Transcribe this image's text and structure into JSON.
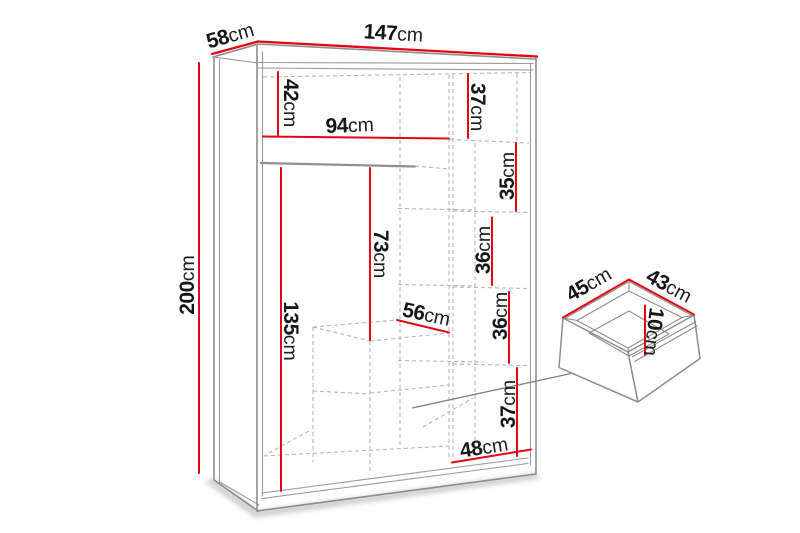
{
  "diagram": {
    "title": "wardrobe-dimension-diagram",
    "unit": "cm",
    "colors": {
      "dimension_line": "#e30613",
      "outline": "#8d8d8d",
      "dashed": "#b7b7b7",
      "label": "#161616"
    },
    "wardrobe": {
      "total_width": {
        "num": "147",
        "unit": "cm"
      },
      "total_depth": {
        "num": "58",
        "unit": "cm"
      },
      "total_height": {
        "num": "200",
        "unit": "cm"
      },
      "top_left_compartment_height": {
        "num": "42",
        "unit": "cm"
      },
      "top_right_compartment_height": {
        "num": "37",
        "unit": "cm"
      },
      "hanging_section_width": {
        "num": "94",
        "unit": "cm"
      },
      "upper_shelf_height": {
        "num": "35",
        "unit": "cm"
      },
      "middle_shelf_height": {
        "num": "36",
        "unit": "cm"
      },
      "rod_to_drawer_height": {
        "num": "73",
        "unit": "cm"
      },
      "hanging_space_height": {
        "num": "135",
        "unit": "cm"
      },
      "drawer_unit_width": {
        "num": "56",
        "unit": "cm"
      },
      "lower_shelf_height": {
        "num": "36",
        "unit": "cm"
      },
      "bottom_compartment_height": {
        "num": "37",
        "unit": "cm"
      },
      "bottom_compartment_width": {
        "num": "48",
        "unit": "cm"
      }
    },
    "drawer": {
      "width": {
        "num": "45",
        "unit": "cm"
      },
      "depth": {
        "num": "43",
        "unit": "cm"
      },
      "height": {
        "num": "10",
        "unit": "cm"
      }
    }
  }
}
